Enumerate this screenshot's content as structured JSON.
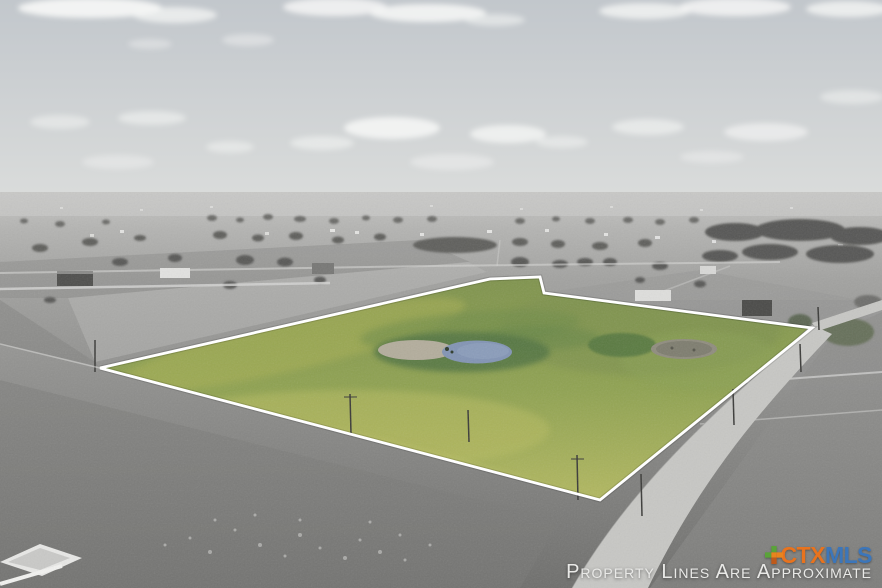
{
  "photo": {
    "description": "Aerial drone photo of flat rural acreage: a highlighted green parcel outlined in white property lines, with a small blue pond and a dry pond inside; surrounding fields, roads, scattered trees and houses are desaturated gray under a hazy cloudy sky",
    "parcel_features": [
      "pond",
      "dry-pond",
      "pasture"
    ]
  },
  "watermark": {
    "text": "Property Lines Are Approximate",
    "color": "#e9e9e7"
  },
  "logo": {
    "name": "CTXMLS",
    "ctx": "CTX",
    "mls": "MLS",
    "ctx_color": "#e8731e",
    "mls_color": "#3c76ba",
    "icon_green": "#5aa339",
    "icon_orange": "#e8841e",
    "icon_dark_orange": "#c05a1a"
  },
  "colors": {
    "boundary_white": "#ffffff",
    "parcel_green_top": "#7f934d",
    "parcel_green_mid": "#8fa251",
    "parcel_green_bottom": "#b2b860",
    "pond_blue": "#8294b4",
    "dirt_tan": "#b3ad9c",
    "sky_top": "#c2c7cc",
    "sky_horizon": "#dadcdb",
    "road_gray": "#c7c7c4"
  }
}
